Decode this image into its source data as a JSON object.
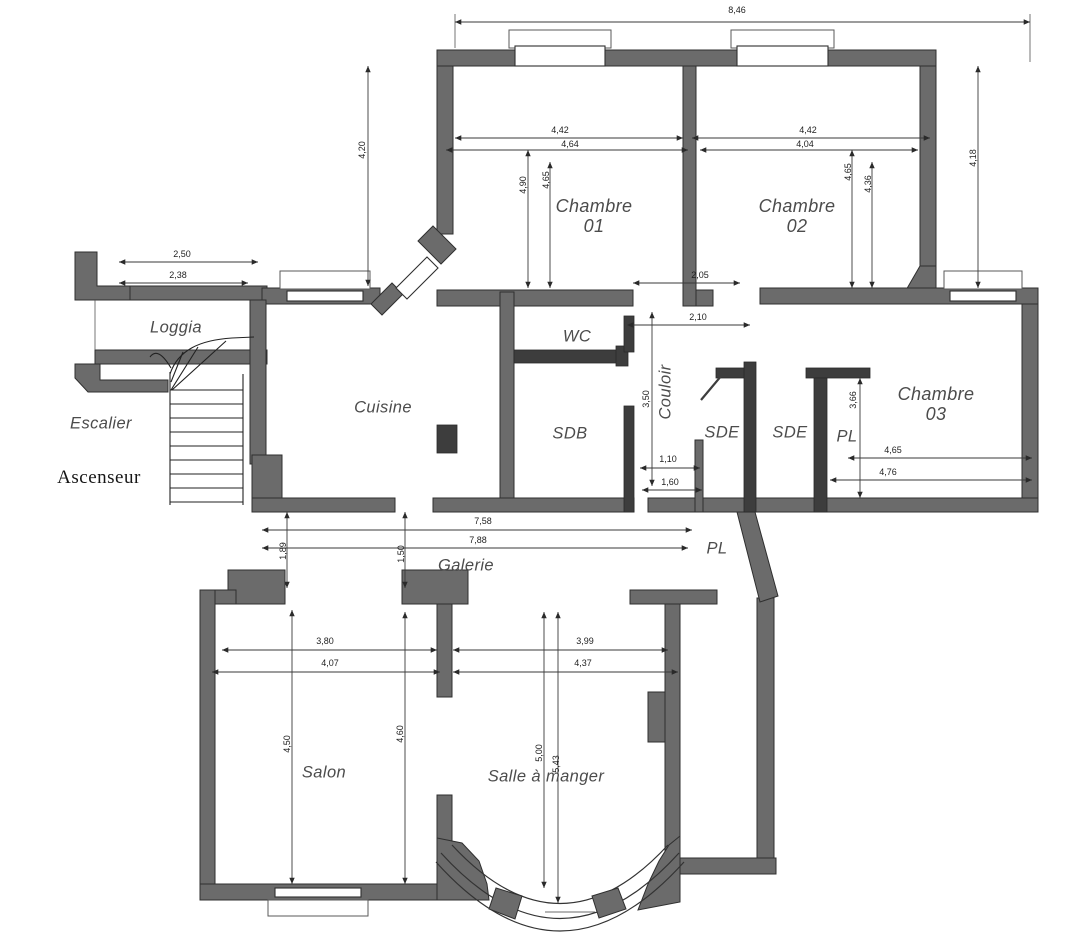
{
  "rooms": {
    "chambre01_l1": "Chambre",
    "chambre01_l2": "01",
    "chambre02_l1": "Chambre",
    "chambre02_l2": "02",
    "chambre03_l1": "Chambre",
    "chambre03_l2": "03",
    "loggia": "Loggia",
    "escalier": "Escalier",
    "ascenseur": "Ascenseur",
    "cuisine": "Cuisine",
    "wc": "WC",
    "sdb": "SDB",
    "couloir": "Couloir",
    "sde1": "SDE",
    "sde2": "SDE",
    "pl1": "PL",
    "pl2": "PL",
    "galerie": "Galerie",
    "salon": "Salon",
    "salle_a_manger": "Salle à manger"
  },
  "dims": {
    "total_top": "8,46",
    "ch01_w1": "4,42",
    "ch01_w2": "4,64",
    "ch01_h1": "4,90",
    "ch01_h2": "4,65",
    "ch02_w1": "4,42",
    "ch02_w2": "4,04",
    "ch02_h1": "4,65",
    "ch02_h2": "4,36",
    "right_side": "4,18",
    "left_side": "4,20",
    "loggia_w1": "2,50",
    "loggia_w2": "2,38",
    "hall_top1": "2,05",
    "hall_top2": "2,10",
    "hall_len": "3,50",
    "sdb_door1": "1,10",
    "sdb_door2": "1,60",
    "ch03_h": "3,66",
    "ch03_w1": "4,65",
    "ch03_w2": "4,76",
    "galerie_w1": "7,58",
    "galerie_w2": "7,88",
    "galerie_h1": "1,89",
    "galerie_h2": "1,50",
    "salon_w1": "3,80",
    "salon_w2": "4,07",
    "salon_h1": "4,50",
    "salon_h2": "4,60",
    "sam_w1": "3,99",
    "sam_w2": "4,37",
    "sam_h1": "5,00",
    "sam_h2": "5,43"
  },
  "colors": {
    "wall": "#6b6b6b",
    "partition": "#3d3d3d",
    "line": "#3a3a3a",
    "room_label": "#4c4c4c",
    "dim_label": "#1f1f1f",
    "background": "#ffffff"
  }
}
